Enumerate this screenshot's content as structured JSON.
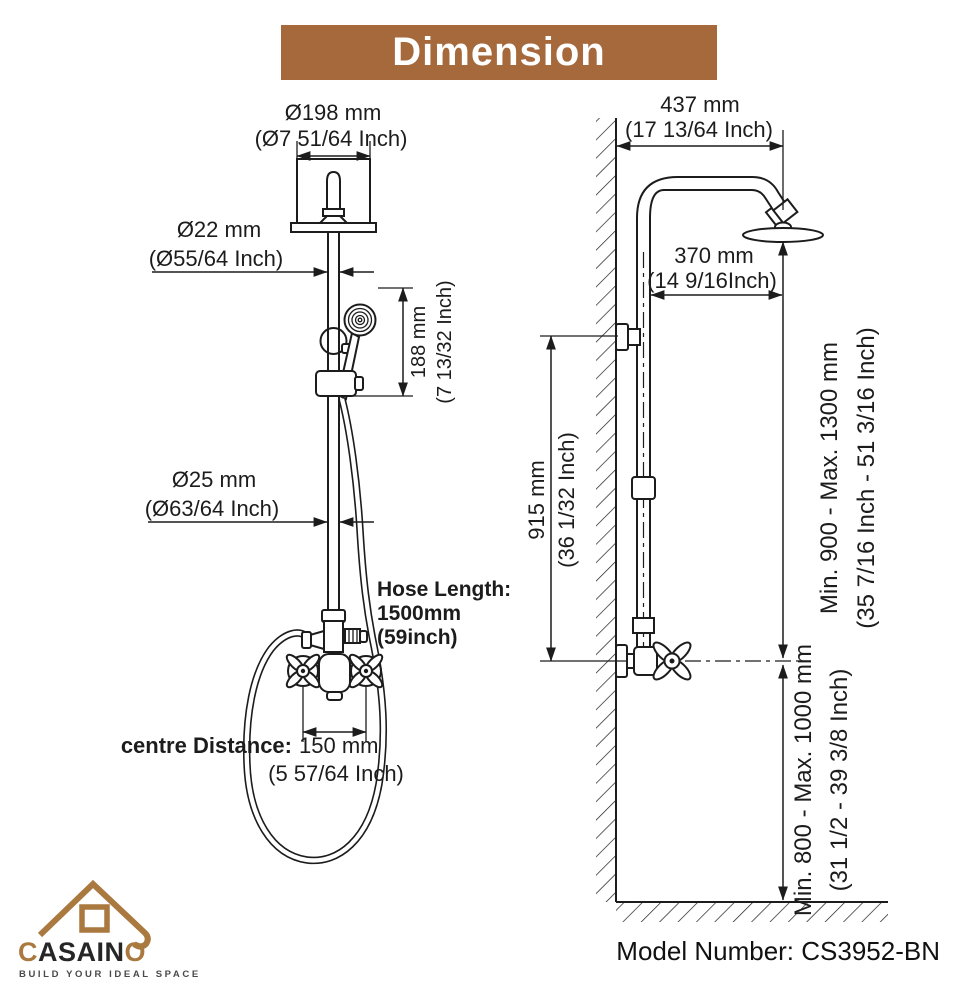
{
  "colors": {
    "accent_brown": "#a5693c",
    "logo_brown": "#a9793f",
    "ink": "#1c1c1c",
    "tagline_gray": "#4a4a4a"
  },
  "banner": {
    "title": "Dimension"
  },
  "front_view": {
    "head_diameter": {
      "mm": "Ø198 mm",
      "inch": "(Ø7 51/64 Inch)"
    },
    "pipe_upper_diameter": {
      "mm": "Ø22 mm",
      "inch": "(Ø55/64 Inch)"
    },
    "handshower_drop": {
      "mm": "188 mm",
      "inch": "(7 13/32 Inch)"
    },
    "pipe_lower_diameter": {
      "mm": "Ø25 mm",
      "inch": "(Ø63/64 Inch)"
    },
    "hose_length": {
      "label": "Hose Length:",
      "mm": "1500mm",
      "inch": "(59inch)"
    },
    "centre_distance": {
      "label": "centre Distance:",
      "mm": "150 mm",
      "inch": "(5 57/64 Inch)"
    }
  },
  "side_view": {
    "overall_width": {
      "mm": "437 mm",
      "inch": "(17 13/64 Inch)"
    },
    "arm_reach": {
      "mm": "370 mm",
      "inch": "(14 9/16Inch)"
    },
    "riser_height": {
      "mm": "915 mm",
      "inch": "(36 1/32 Inch)"
    },
    "head_height_range": {
      "mm": "Min. 900 - Max. 1300 mm",
      "inch": "(35 7/16 Inch - 51 3/16 Inch)"
    },
    "valve_height_range": {
      "mm": "Min. 800 - Max. 1000 mm",
      "inch": "(31 1/2 - 39 3/8 Inch)"
    }
  },
  "footer": {
    "logo": {
      "brand_first": "C",
      "brand_mid": "ASAIN",
      "brand_last": "O",
      "tagline": "BUILD YOUR IDEAL SPACE"
    },
    "model": {
      "label": "Model Number:",
      "value": "CS3952-BN"
    }
  }
}
